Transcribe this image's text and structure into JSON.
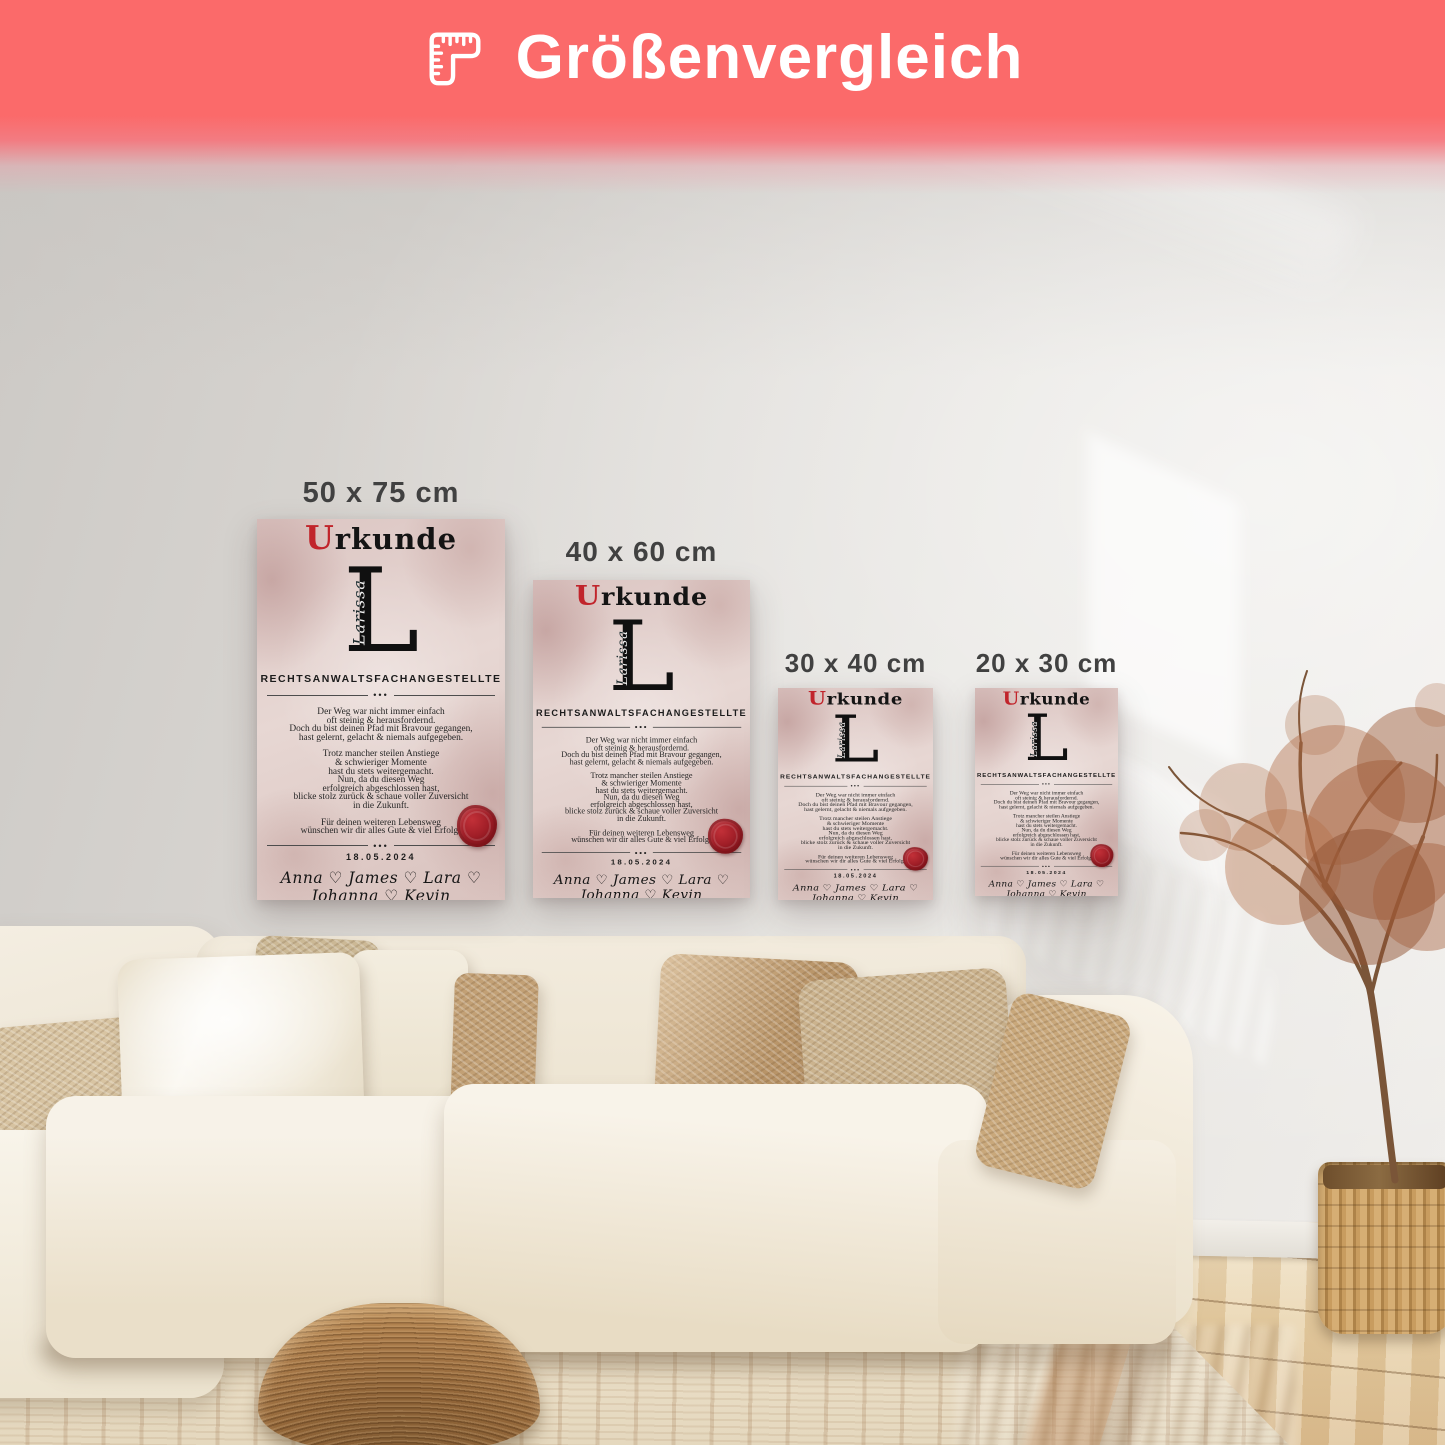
{
  "header": {
    "title": "Größenvergleich",
    "icon": "corner-ruler-icon",
    "banner_color": "#FB6A6A",
    "text_color": "#FFFFFF"
  },
  "posters": [
    {
      "label": "50 x 75 cm"
    },
    {
      "label": "40 x 60 cm"
    },
    {
      "label": "30 x 40 cm"
    },
    {
      "label": "20 x 30 cm"
    }
  ],
  "certificate": {
    "title_initial": "U",
    "title_rest": "rkunde",
    "monogram_letter": "L",
    "monogram_name": "Larissa",
    "profession": "RECHTSANWALTSFACHANGESTELLTE",
    "divider_dots": "•••",
    "para1": [
      "Der Weg war nicht immer einfach",
      "oft steinig & herausfordernd.",
      "Doch du bist deinen Pfad mit Bravour gegangen,",
      "hast gelernt, gelacht & niemals aufgegeben."
    ],
    "para2": [
      "Trotz mancher steilen Anstiege",
      "& schwieriger Momente",
      "hast du stets weitergemacht.",
      "Nun, da du diesen Weg",
      "erfolgreich abgeschlossen hast,",
      "blicke stolz zurück & schaue voller Zuversicht",
      "in die Zukunft."
    ],
    "para3": [
      "Für deinen weiteren Lebensweg",
      "wünschen wir dir alles Gute & viel Erfolg!"
    ],
    "date": "18.05.2024",
    "names": "Anna ♡ James ♡ Lara ♡ Johanna ♡ Kevin",
    "accent_red": "#C1242B",
    "seal_color": "#9E1F26",
    "paper_color": "#E2CFCB"
  },
  "scene": {
    "wall_color": "#DDDAD6",
    "sofa_color": "#F2EBDD",
    "pillow_tan_color": "#BC9768",
    "floor_color": "#E5CEA4",
    "rug_color": "#E8DCC6",
    "pouf_color": "#996B3D",
    "basket_color": "#C59A5E"
  }
}
